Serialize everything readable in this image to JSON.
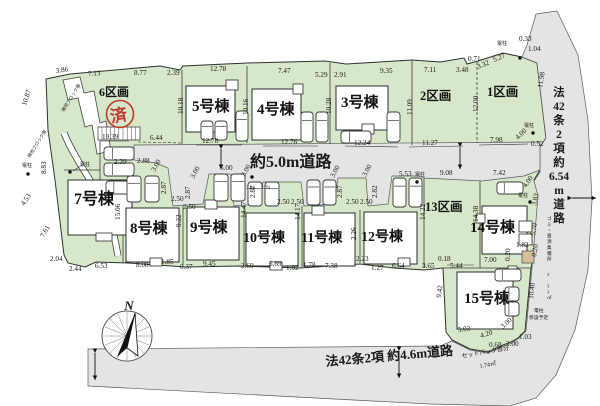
{
  "page": {
    "background": "#ffffff"
  },
  "map": {
    "colors": {
      "lot_green": "#d6e8c9",
      "road_gray": "#e4e4e6",
      "stamp_red": "#c0392b",
      "tan": "#d8bf9a"
    },
    "lots": [
      {
        "label": "6区画"
      },
      {
        "label": "5号棟"
      },
      {
        "label": "4号棟"
      },
      {
        "label": "3号棟"
      },
      {
        "label": "2区画"
      },
      {
        "label": "1区画"
      },
      {
        "label": "7号棟"
      },
      {
        "label": "8号棟"
      },
      {
        "label": "9号棟"
      },
      {
        "label": "10号棟"
      },
      {
        "label": "11号棟"
      },
      {
        "label": "12号棟"
      },
      {
        "label": "13区画"
      },
      {
        "label": "14号棟"
      },
      {
        "label": "15号棟"
      }
    ],
    "stamp_label": "済",
    "roads": {
      "main_label": "約5.0m道路",
      "right_label": "法42条2項約6.54m道路",
      "right_stack": [
        "法",
        "42",
        "条",
        "2",
        "項",
        "約",
        "6.54",
        "m",
        "道",
        "路"
      ],
      "bottom_label": "法42条2項 約4.6m道路"
    },
    "compass_label": "N",
    "dim_labels": [
      {
        "t": "3.86",
        "x": 56,
        "y": 73,
        "r": -8
      },
      {
        "t": "7.13",
        "x": 88,
        "y": 76,
        "r": -4
      },
      {
        "t": "8.77",
        "x": 134,
        "y": 75
      },
      {
        "t": "2.39",
        "x": 167,
        "y": 75
      },
      {
        "t": "12.78",
        "x": 210,
        "y": 71
      },
      {
        "t": "7.47",
        "x": 278,
        "y": 73
      },
      {
        "t": "5.29",
        "x": 315,
        "y": 77
      },
      {
        "t": "2.91",
        "x": 334,
        "y": 77
      },
      {
        "t": "9.35",
        "x": 380,
        "y": 73
      },
      {
        "t": "7.11",
        "x": 424,
        "y": 72
      },
      {
        "t": "0.71",
        "x": 468,
        "y": 61
      },
      {
        "t": "3.48",
        "x": 456,
        "y": 72
      },
      {
        "t": "3.32",
        "x": 478,
        "y": 69,
        "r": -22
      },
      {
        "t": "5.27",
        "x": 494,
        "y": 62,
        "r": -22
      },
      {
        "t": "0.33",
        "x": 519,
        "y": 41
      },
      {
        "t": "1.04",
        "x": 528,
        "y": 51
      },
      {
        "t": "電柱",
        "x": 497,
        "y": 45,
        "s": 5,
        "n": "utility-pole-label"
      },
      {
        "t": "10.87",
        "x": 26,
        "y": 106,
        "r": -72
      },
      {
        "t": "8.83",
        "x": 46,
        "y": 174,
        "r": -90
      },
      {
        "t": "4.53",
        "x": 24,
        "y": 206,
        "r": -55
      },
      {
        "t": "7.61",
        "x": 44,
        "y": 238,
        "r": -62
      },
      {
        "t": "2.04",
        "x": 50,
        "y": 261
      },
      {
        "t": "2.44",
        "x": 69,
        "y": 271
      },
      {
        "t": "6.53",
        "x": 95,
        "y": 268
      },
      {
        "t": "隣地ブロック塀",
        "x": 64,
        "y": 112,
        "r": -58,
        "s": 4.5,
        "n": "wall-note"
      },
      {
        "t": "隣地ブロック塀",
        "x": 30,
        "y": 158,
        "r": -58,
        "s": 4.5,
        "n": "wall-note"
      },
      {
        "t": "電柱",
        "x": 22,
        "y": 167,
        "s": 5,
        "n": "utility-pole-label"
      },
      {
        "t": "電柱",
        "x": 80,
        "y": 166,
        "s": 5,
        "n": "utility-pole-label"
      },
      {
        "t": "19.39",
        "x": 102,
        "y": 139
      },
      {
        "t": "6.44",
        "x": 150,
        "y": 140
      },
      {
        "t": "10.18",
        "x": 183,
        "y": 114,
        "r": -90
      },
      {
        "t": "2.39",
        "x": 114,
        "y": 164
      },
      {
        "t": "2.88",
        "x": 137,
        "y": 163
      },
      {
        "t": "12.78",
        "x": 202,
        "y": 143
      },
      {
        "t": "10.16",
        "x": 248,
        "y": 115,
        "r": -90
      },
      {
        "t": "12.76",
        "x": 281,
        "y": 144
      },
      {
        "t": "10.28",
        "x": 331,
        "y": 114,
        "r": -90
      },
      {
        "t": "12.24",
        "x": 354,
        "y": 145
      },
      {
        "t": "11.09",
        "x": 412,
        "y": 115,
        "r": -90
      },
      {
        "t": "11.27",
        "x": 422,
        "y": 145
      },
      {
        "t": "12.00",
        "x": 478,
        "y": 112,
        "r": -90
      },
      {
        "t": "7.98",
        "x": 490,
        "y": 142
      },
      {
        "t": "11.98",
        "x": 542,
        "y": 88,
        "r": -80
      },
      {
        "t": "4.00",
        "x": 518,
        "y": 140,
        "r": -45
      },
      {
        "t": "0.52",
        "x": 531,
        "y": 146
      },
      {
        "t": "電柱",
        "x": 524,
        "y": 127,
        "s": 5,
        "n": "utility-pole-label"
      },
      {
        "t": "3.00",
        "x": 155,
        "y": 172,
        "r": -62
      },
      {
        "t": "2.87",
        "x": 166,
        "y": 194,
        "r": -90
      },
      {
        "t": "2.50",
        "x": 171,
        "y": 201
      },
      {
        "t": "2.50",
        "x": 183,
        "y": 209
      },
      {
        "t": "3.00",
        "x": 194,
        "y": 179,
        "r": -62
      },
      {
        "t": "2.87",
        "x": 190,
        "y": 199,
        "r": -90
      },
      {
        "t": "6.00",
        "x": 220,
        "y": 170
      },
      {
        "t": "3.00",
        "x": 245,
        "y": 177,
        "r": -62
      },
      {
        "t": "2.87",
        "x": 255,
        "y": 198,
        "r": -90
      },
      {
        "t": "3.44",
        "x": 246,
        "y": 189,
        "s": 5
      },
      {
        "t": "3.79",
        "x": 261,
        "y": 189,
        "s": 5
      },
      {
        "t": "2.50",
        "x": 277,
        "y": 204
      },
      {
        "t": "2.50",
        "x": 291,
        "y": 204
      },
      {
        "t": "3.00",
        "x": 334,
        "y": 178,
        "r": -62
      },
      {
        "t": "2.87",
        "x": 342,
        "y": 198,
        "r": -90
      },
      {
        "t": "2.50",
        "x": 346,
        "y": 204
      },
      {
        "t": "2.50",
        "x": 360,
        "y": 204
      },
      {
        "t": "3.00",
        "x": 366,
        "y": 177,
        "r": -62
      },
      {
        "t": "2.82",
        "x": 377,
        "y": 198,
        "r": -90
      },
      {
        "t": "5.53",
        "x": 399,
        "y": 176
      },
      {
        "t": "電柱",
        "x": 415,
        "y": 176,
        "s": 5,
        "n": "utility-pole-label"
      },
      {
        "t": "9.08",
        "x": 440,
        "y": 175
      },
      {
        "t": "7.42",
        "x": 493,
        "y": 175
      },
      {
        "t": "4.00",
        "x": 526,
        "y": 188,
        "r": -55
      },
      {
        "t": "電柱",
        "x": 518,
        "y": 197,
        "s": 5,
        "n": "utility-pole-label"
      },
      {
        "t": "3.83",
        "x": 536,
        "y": 206,
        "r": -78
      },
      {
        "t": "5.70",
        "x": 535,
        "y": 236,
        "r": -80
      },
      {
        "t": "0.20",
        "x": 536,
        "y": 257,
        "r": -80
      },
      {
        "t": "1.82",
        "x": 516,
        "y": 247
      },
      {
        "t": "0.20",
        "x": 510,
        "y": 261,
        "r": -90
      },
      {
        "t": "7.00",
        "x": 484,
        "y": 262
      },
      {
        "t": "14.38",
        "x": 478,
        "y": 222,
        "r": -90
      },
      {
        "t": "14.22",
        "x": 425,
        "y": 220,
        "r": -90
      },
      {
        "t": "10.40",
        "x": 533,
        "y": 299,
        "r": -84
      },
      {
        "t": "電柱",
        "x": 534,
        "y": 312,
        "s": 4.8,
        "n": "pole-relocation-note"
      },
      {
        "t": "移設予定",
        "x": 529,
        "y": 319,
        "s": 4.8,
        "n": "pole-relocation-note"
      },
      {
        "t": "ゴミ・資源集積所",
        "x": 547,
        "y": 220,
        "v": 1,
        "s": 4.6,
        "n": "garbage-area-note"
      },
      {
        "t": "3.33㎡",
        "x": 547,
        "y": 276,
        "v": 1,
        "s": 4.6,
        "n": "garbage-area-note"
      },
      {
        "t": "0.18",
        "x": 438,
        "y": 261
      },
      {
        "t": "5.44",
        "x": 450,
        "y": 268
      },
      {
        "t": "3.65",
        "x": 422,
        "y": 268
      },
      {
        "t": "9.42",
        "x": 441,
        "y": 298,
        "r": -84
      },
      {
        "t": "15.06",
        "x": 120,
        "y": 220,
        "r": -90
      },
      {
        "t": "9.22",
        "x": 181,
        "y": 227,
        "r": -90
      },
      {
        "t": "14.47",
        "x": 246,
        "y": 218,
        "r": -90
      },
      {
        "t": "14.17",
        "x": 300,
        "y": 220,
        "r": -90
      },
      {
        "t": "2.26",
        "x": 356,
        "y": 240,
        "r": -90
      },
      {
        "t": "2.23",
        "x": 356,
        "y": 261
      },
      {
        "t": "8.08",
        "x": 136,
        "y": 267
      },
      {
        "t": "1.85",
        "x": 161,
        "y": 264
      },
      {
        "t": "0.37",
        "x": 180,
        "y": 269
      },
      {
        "t": "9.45",
        "x": 203,
        "y": 266
      },
      {
        "t": "2.69",
        "x": 241,
        "y": 268
      },
      {
        "t": "6.89",
        "x": 269,
        "y": 266
      },
      {
        "t": "1.02",
        "x": 286,
        "y": 270
      },
      {
        "t": "1.78",
        "x": 303,
        "y": 267
      },
      {
        "t": "7.38",
        "x": 325,
        "y": 268
      },
      {
        "t": "1.27",
        "x": 371,
        "y": 270
      },
      {
        "t": "6.64",
        "x": 392,
        "y": 268
      },
      {
        "t": "5.03",
        "x": 458,
        "y": 332,
        "r": -6
      },
      {
        "t": "4.20",
        "x": 481,
        "y": 338,
        "r": -18
      },
      {
        "t": "3.00",
        "x": 503,
        "y": 329,
        "r": -42
      },
      {
        "t": "1.03",
        "x": 519,
        "y": 339
      },
      {
        "t": "0.68",
        "x": 489,
        "y": 347
      },
      {
        "t": "2.00",
        "x": 506,
        "y": 346
      },
      {
        "t": "セットバック部分",
        "x": 462,
        "y": 358,
        "r": -10,
        "s": 6,
        "n": "setback-note"
      },
      {
        "t": "1.74㎡",
        "x": 480,
        "y": 368,
        "r": -10,
        "s": 6,
        "n": "setback-note"
      }
    ]
  }
}
